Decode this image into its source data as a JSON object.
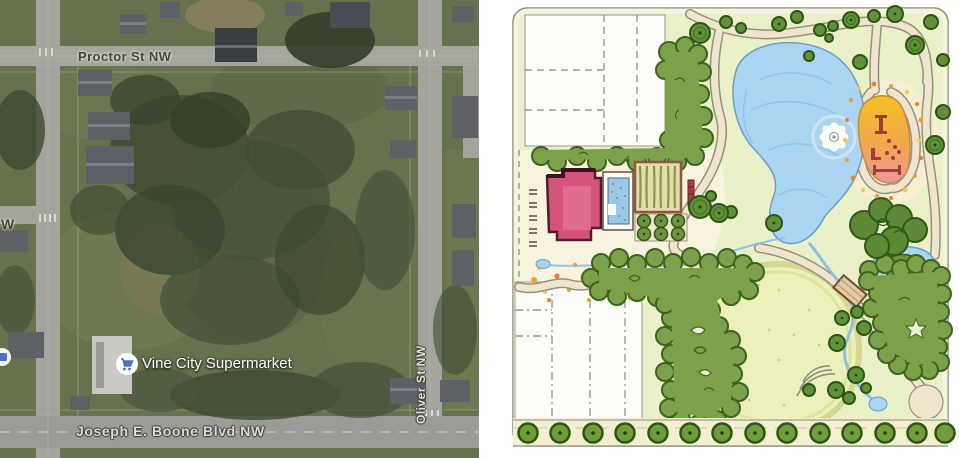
{
  "window": {
    "width": 959,
    "height": 458,
    "description": "Side-by-side comparison: satellite photo of site (left) and hand-drawn park master plan (right)"
  },
  "left_map": {
    "type": "satellite-imagery",
    "labels": {
      "street_top": "Proctor St NW",
      "street_right": "Oliver St NW",
      "street_bottom": "Joseph E. Boone Blvd NW",
      "street_left_partial": "W",
      "poi": "Vine City Supermarket"
    },
    "icons": {
      "poi": "shopping-cart-icon",
      "edge_poi": "poi-marker-icon"
    },
    "colors": {
      "grass": "#66724d",
      "trees": "#3c4731",
      "road": "#a3a49c",
      "road_major": "#9b9c96",
      "label_dark": "#45443f",
      "label_light": "#dcdcd6",
      "poi_blue": "#4a72c4"
    }
  },
  "right_plan": {
    "type": "hand-drawn-site-plan",
    "colors": {
      "paper": "#ffffff",
      "plan_background": "#eaf0c8",
      "cream": "#f8f3df",
      "lawn": "#ecf1bc",
      "tree_mass": "#7da04a",
      "tree_dark": "#3c641d",
      "water": "#a9d5f2",
      "water_edge": "#6b9ec4",
      "building_pink": "#d6537b",
      "building_outline": "#4f1d2c",
      "playground_yellow": "#f5c028",
      "playground_pink": "#ec97a0",
      "equipment_red": "#9c3f3f",
      "path_tan": "#efe6cd",
      "path_edge": "#97917e",
      "flowers_orange": "#f0a030",
      "flowers_yellow": "#f5c84a"
    }
  }
}
